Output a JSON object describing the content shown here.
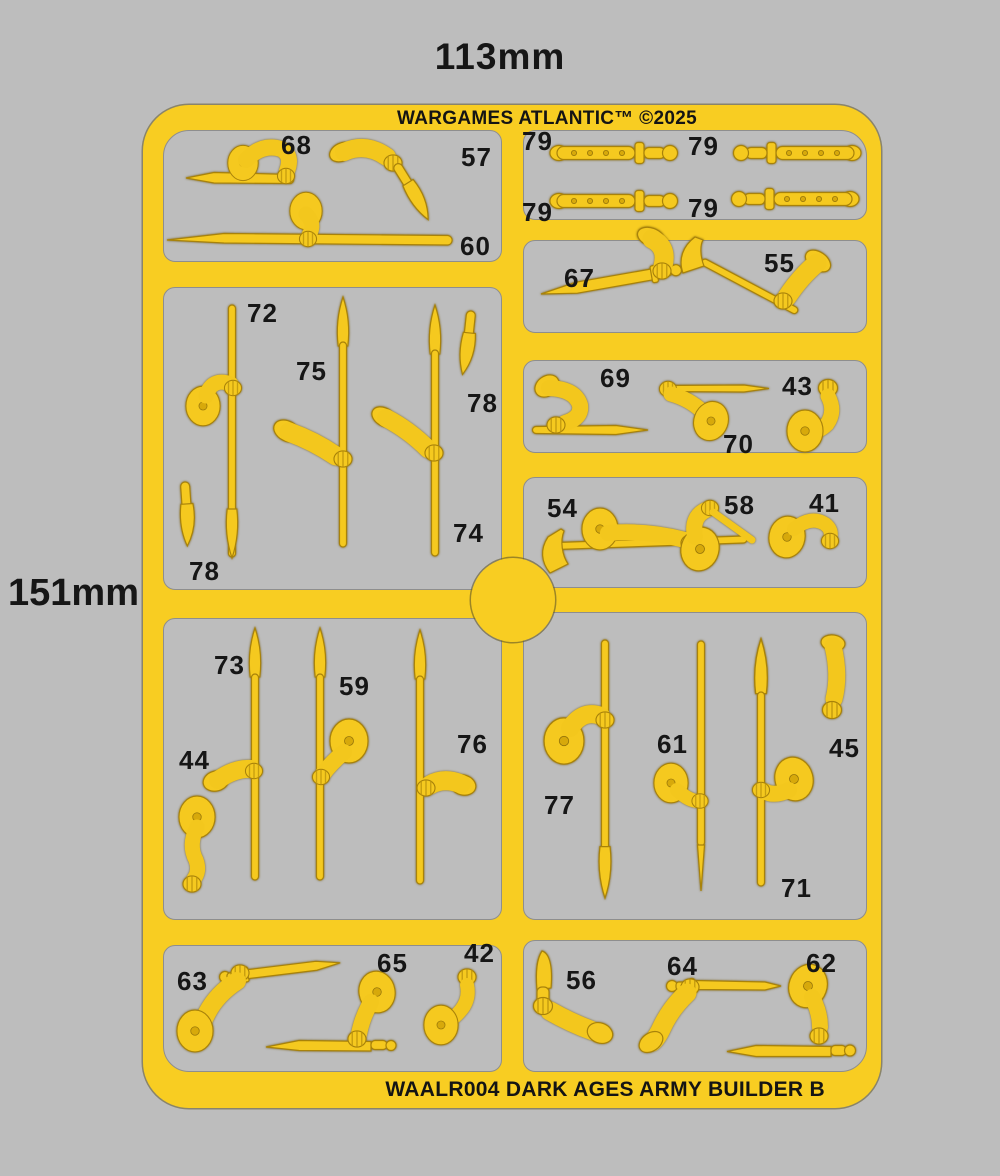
{
  "image": {
    "width_label": "113mm",
    "height_label": "151mm"
  },
  "sprue": {
    "brand_text": "WARGAMES ATLANTIC™ ©2025",
    "product_code": "WAALR004 DARK AGES ARMY BUILDER B",
    "colors": {
      "sprue_yellow": "#f8cd22",
      "part_yellow": "#f5c91f",
      "background_gray": "#bdbdbd",
      "label_text": "#161616"
    }
  },
  "parts": [
    {
      "label": "68",
      "kind": "arm-with-dagger"
    },
    {
      "label": "57",
      "kind": "arm-with-knife"
    },
    {
      "label": "60",
      "kind": "arm-with-spear"
    },
    {
      "label": "79",
      "kind": "sheathed-sword"
    },
    {
      "label": "79",
      "kind": "sheathed-sword"
    },
    {
      "label": "79",
      "kind": "sheathed-sword"
    },
    {
      "label": "79",
      "kind": "sheathed-sword"
    },
    {
      "label": "67",
      "kind": "arm-with-sword"
    },
    {
      "label": "55",
      "kind": "arm-with-axe"
    },
    {
      "label": "72",
      "kind": "arm-with-spear"
    },
    {
      "label": "75",
      "kind": "arm-with-spear"
    },
    {
      "label": "78",
      "kind": "knife"
    },
    {
      "label": "74",
      "kind": "arm-with-spear"
    },
    {
      "label": "78",
      "kind": "knife"
    },
    {
      "label": "69",
      "kind": "arm-with-dagger"
    },
    {
      "label": "70",
      "kind": "arm-with-spear"
    },
    {
      "label": "43",
      "kind": "bent-arm"
    },
    {
      "label": "54",
      "kind": "arm-with-axe"
    },
    {
      "label": "58",
      "kind": "pointing-arm"
    },
    {
      "label": "41",
      "kind": "bent-arm"
    },
    {
      "label": "73",
      "kind": "arm-with-spear"
    },
    {
      "label": "44",
      "kind": "hanging-arm"
    },
    {
      "label": "59",
      "kind": "arm-with-spear"
    },
    {
      "label": "76",
      "kind": "arm-with-spear"
    },
    {
      "label": "77",
      "kind": "arm-with-spear"
    },
    {
      "label": "61",
      "kind": "arm-with-spear"
    },
    {
      "label": "45",
      "kind": "forearm"
    },
    {
      "label": "71",
      "kind": "arm-with-spear"
    },
    {
      "label": "63",
      "kind": "arm-with-sword"
    },
    {
      "label": "65",
      "kind": "arm-with-sword"
    },
    {
      "label": "42",
      "kind": "bent-arm"
    },
    {
      "label": "56",
      "kind": "arm-with-knife"
    },
    {
      "label": "64",
      "kind": "arm-with-sword"
    },
    {
      "label": "62",
      "kind": "arm-with-sword"
    }
  ]
}
